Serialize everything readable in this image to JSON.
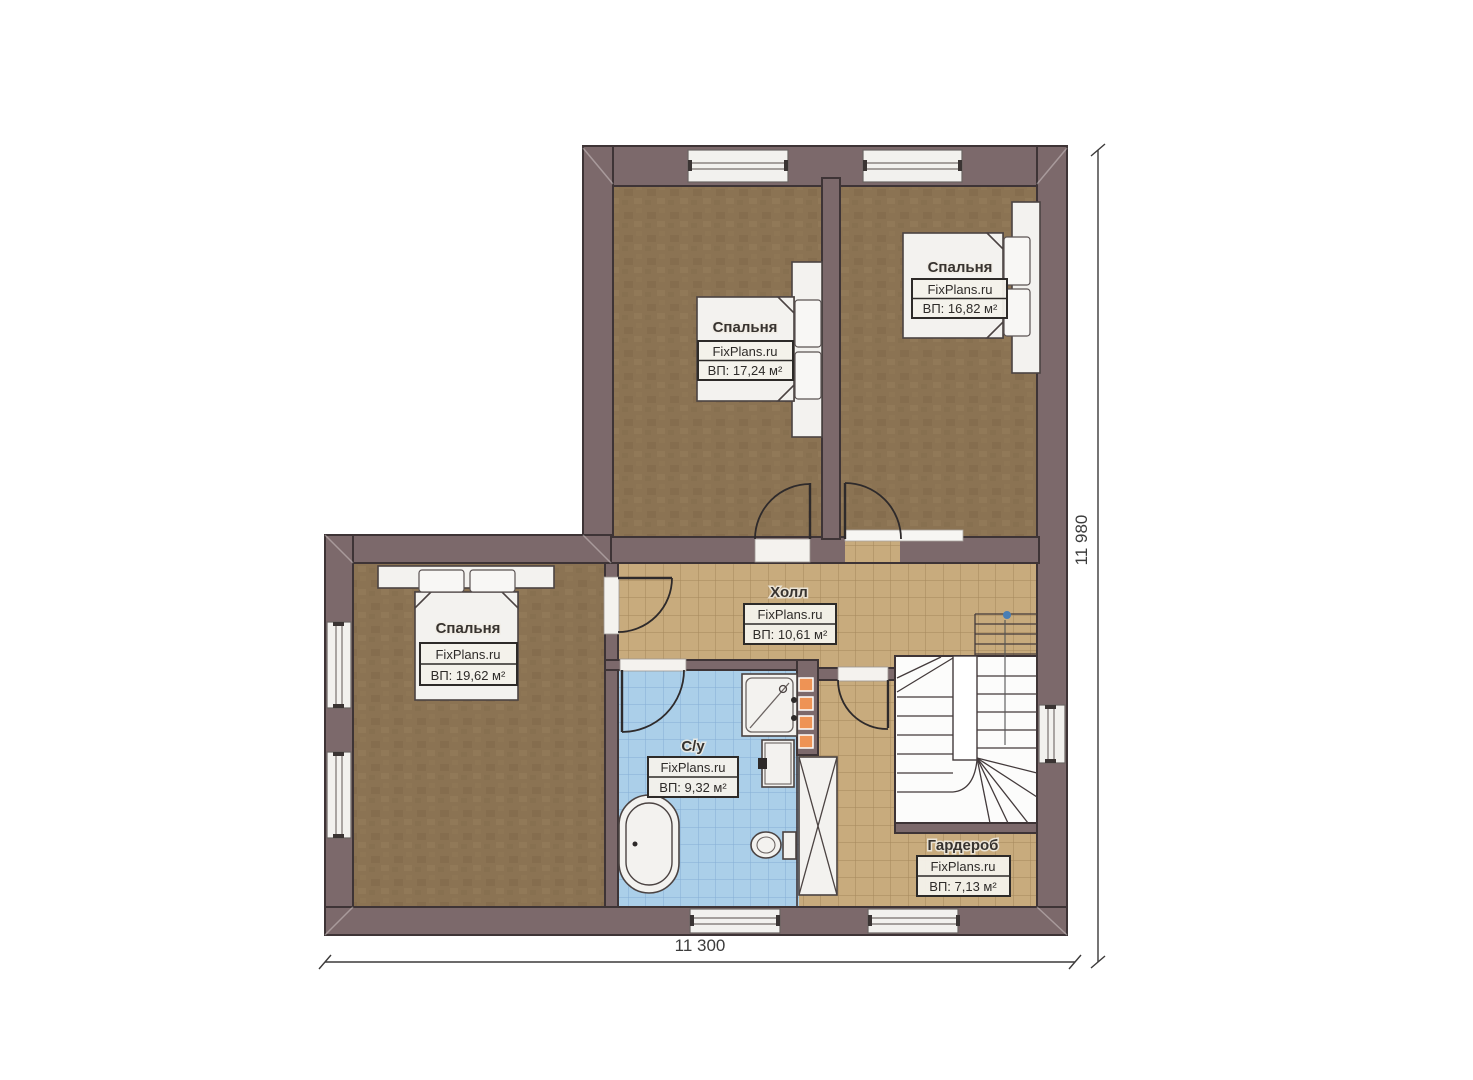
{
  "plan": {
    "brand": "FixPlans.ru",
    "rooms": [
      {
        "name": "Спальня",
        "brand": "FixPlans.ru",
        "area": "ВП: 17,24 м²"
      },
      {
        "name": "Спальня",
        "brand": "FixPlans.ru",
        "area": "ВП: 16,82 м²"
      },
      {
        "name": "Спальня",
        "brand": "FixPlans.ru",
        "area": "ВП: 19,62 м²"
      },
      {
        "name": "Холл",
        "brand": "FixPlans.ru",
        "area": "ВП: 10,61 м²"
      },
      {
        "name": "С/у",
        "brand": "FixPlans.ru",
        "area": "ВП: 9,32 м²"
      },
      {
        "name": "Гардероб",
        "brand": "FixPlans.ru",
        "area": "ВП: 7,13 м²"
      }
    ],
    "dimensions": {
      "bottom": "11 300",
      "right": "11 980"
    },
    "colors": {
      "wall": "#7c696b",
      "bedroom_floor": "#8b7353",
      "hall_tile": "#c8ab7d",
      "bath_tile": "#abcfe9",
      "accent_orange": "#ee9355",
      "stair_marker_blue": "#4a7fb5"
    }
  }
}
